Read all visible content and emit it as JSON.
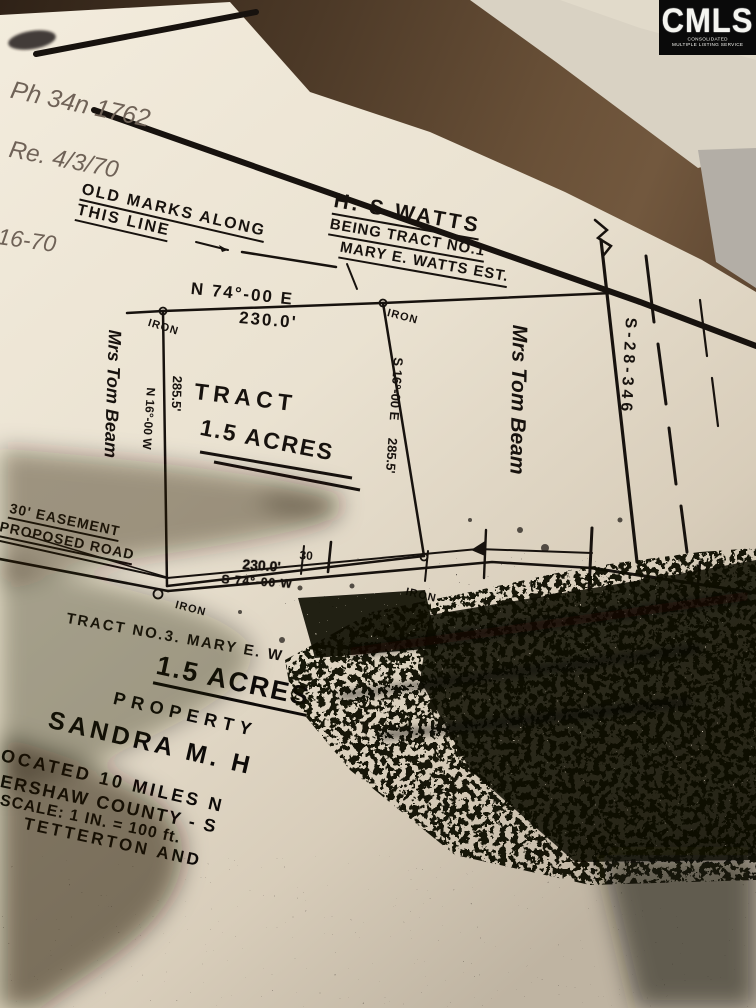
{
  "badge": {
    "logo": "CMLS",
    "tagline_line1": "CONSOLIDATED",
    "tagline_line2": "MULTIPLE LISTING SERVICE"
  },
  "handwritten_notes": {
    "phone_note": "Ph   34n 1762",
    "received_note": "Re.  4/3/70",
    "margin_date": "-16-70",
    "old_marks_line1": "OLD MARKS ALONG",
    "old_marks_line2": "THIS LINE"
  },
  "plat": {
    "owner_block": {
      "line1": "H. S WATTS",
      "line2": "BEING TRACT NO.1",
      "line3": "MARY E. WATTS EST."
    },
    "north_bearing": "N 74°-00 E",
    "north_distance": "230.0'",
    "tract_label_line1": "TRACT",
    "tract_label_line2": "1.5 ACRES",
    "west_distance": "285.5'",
    "west_bearing": "N 16°-00 W",
    "east_bearing": "S 16°-00 E",
    "east_distance": "285.5'",
    "neighbor_west": "Mrs Tom Beam",
    "neighbor_east": "Mrs Tom Beam",
    "road_name": "S-28-346",
    "easement_line1": "30' EASEMENT",
    "easement_line2": "PROPOSED ROAD",
    "easement_width": "30",
    "south_distance": "230.0'",
    "south_bearing": "S 74°-00 W",
    "iron_nw": "IRON",
    "iron_ne": "IRON",
    "iron_sw": "IRON",
    "iron_se": "IRON",
    "south_tract_note": "TRACT NO.3. MARY E. W"
  },
  "title_block": {
    "acreage": "1.5 ACRES",
    "property_of": "PROPERTY",
    "owner": "SANDRA M. H",
    "located": "LOCATED 10 MILES N",
    "county": "KERSHAW COUNTY - S",
    "scale": "SCALE: 1 IN. = 100 ft.",
    "surveyor": "TETTERTON AND"
  },
  "colors": {
    "ink": "#17120e",
    "pencil": "#6f6257",
    "paper": "#e9e1d2",
    "surface_brown": "#5a4430",
    "badge_bg": "#0a0a0a"
  }
}
